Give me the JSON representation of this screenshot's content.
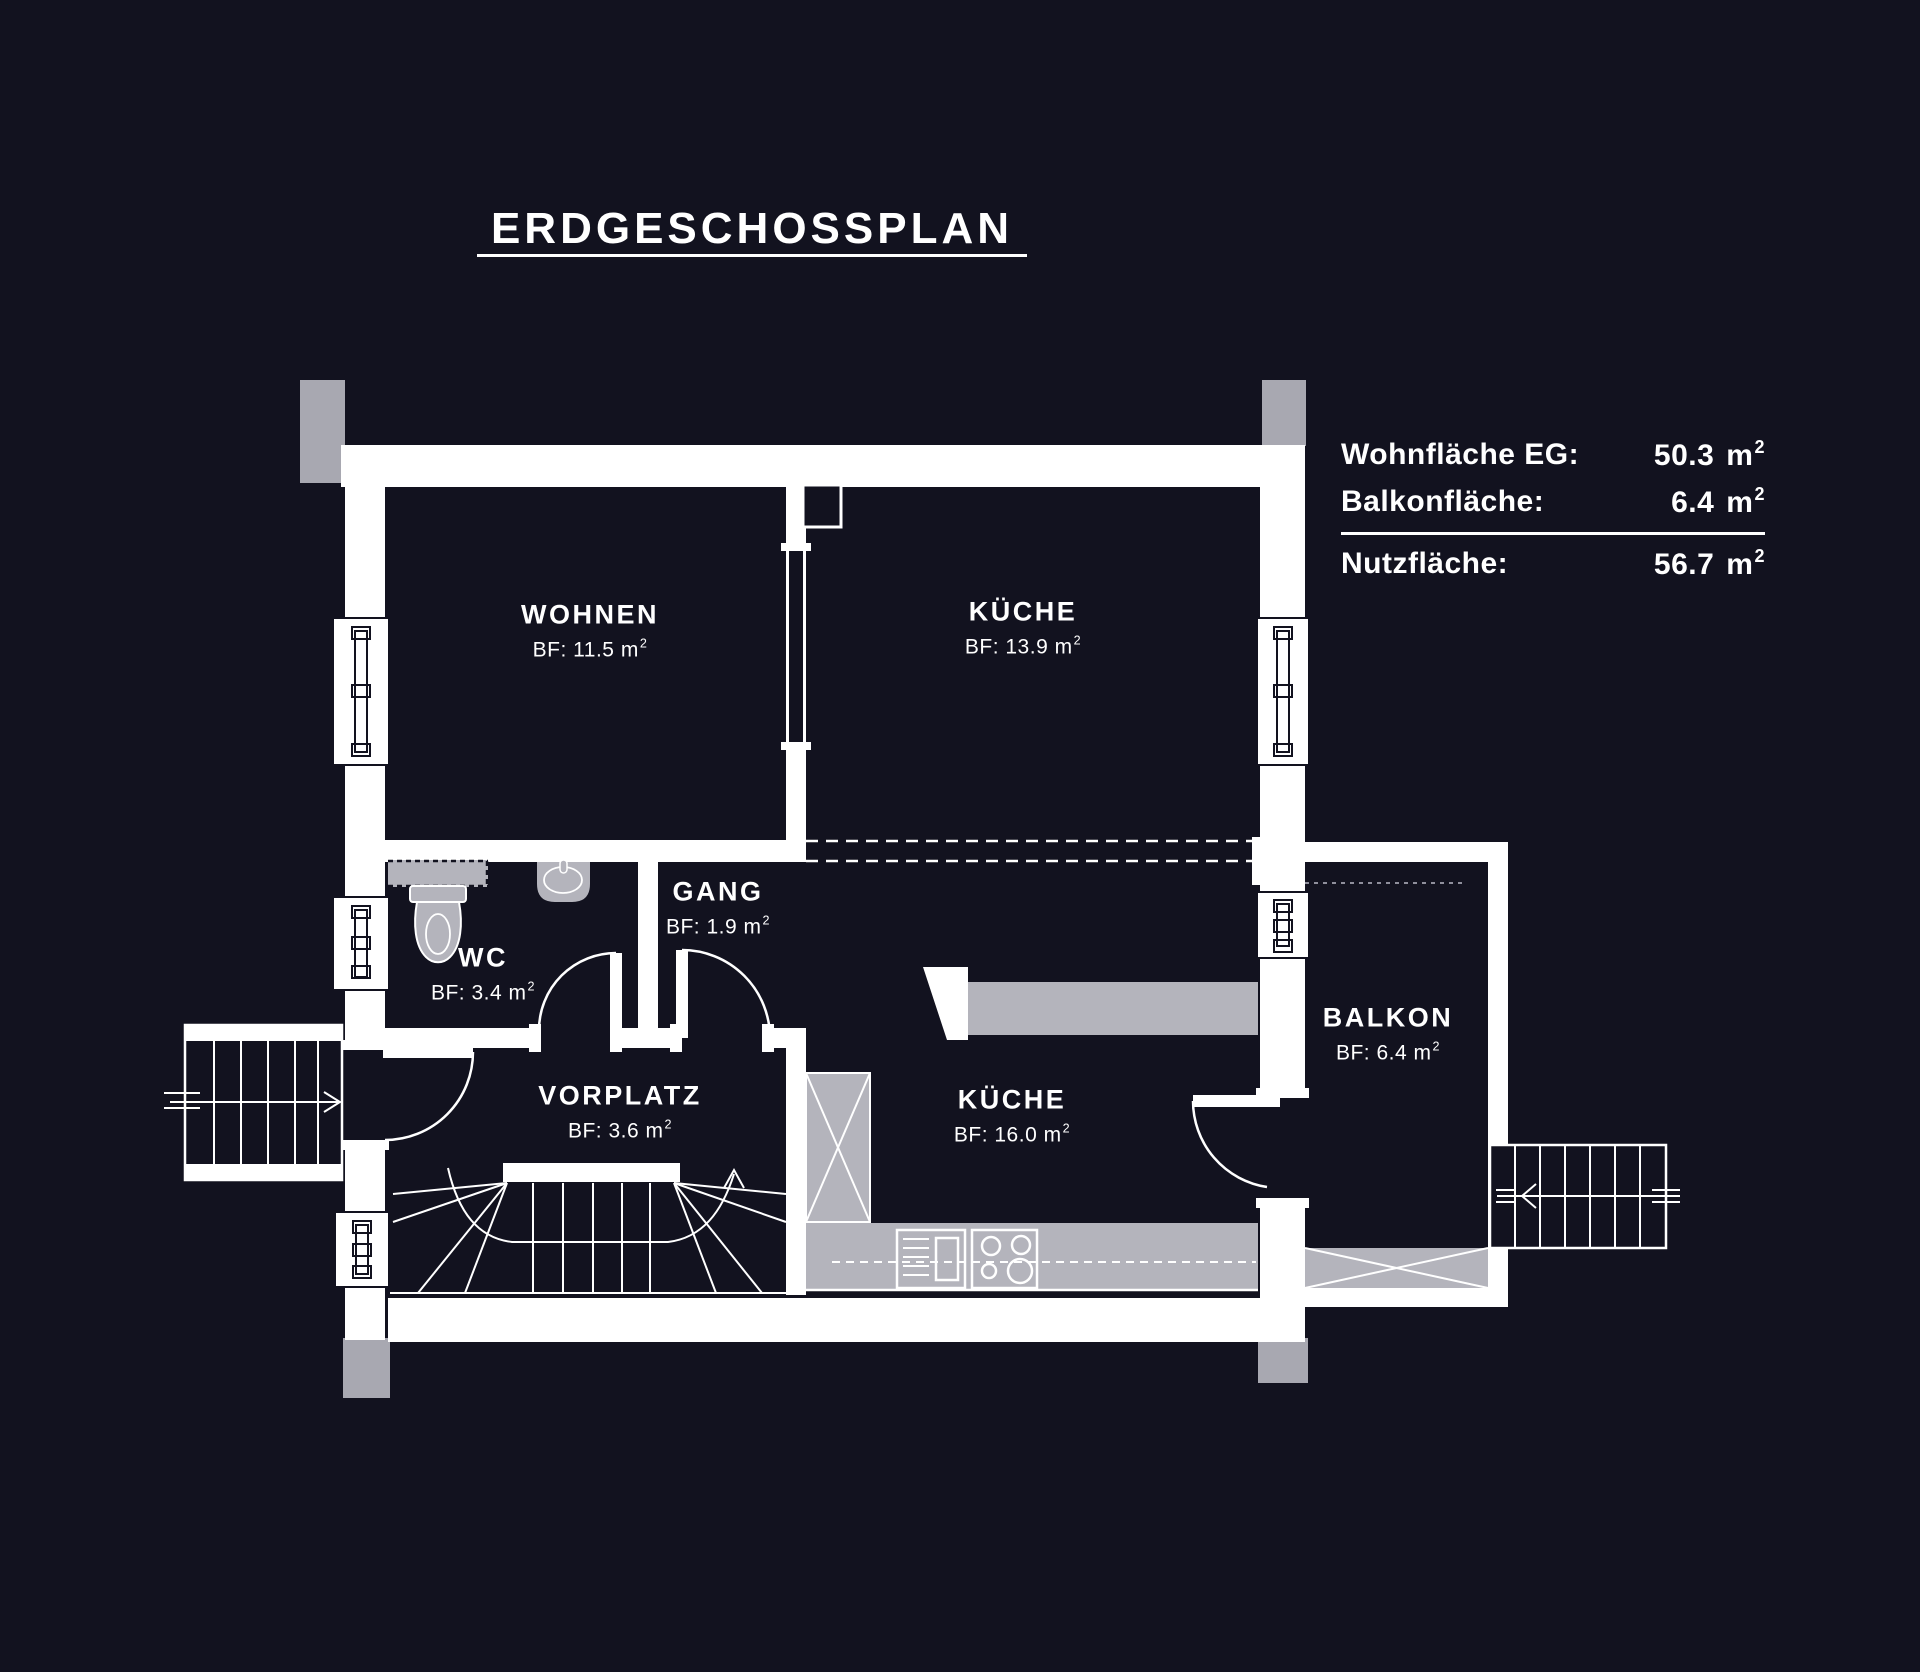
{
  "title": {
    "text": "ERDGESCHOSSPLAN"
  },
  "legend": {
    "rows": [
      {
        "label": "Wohnfläche EG:",
        "value": "50.3",
        "unit": "m",
        "exponent": "2"
      },
      {
        "label": "Balkonfläche:",
        "value": "6.4",
        "unit": "m",
        "exponent": "2"
      },
      {
        "label": "Nutzfläche:",
        "value": "56.7",
        "unit": "m",
        "exponent": "2"
      }
    ]
  },
  "rooms": [
    {
      "id": "wohnen",
      "name": "WOHNEN",
      "area_prefix": "BF: 11.5",
      "unit": "m",
      "exponent": "2"
    },
    {
      "id": "kueche-oben",
      "name": "KÜCHE",
      "area_prefix": "BF: 13.9",
      "unit": "m",
      "exponent": "2"
    },
    {
      "id": "wc",
      "name": "WC",
      "area_prefix": "BF: 3.4",
      "unit": "m",
      "exponent": "2"
    },
    {
      "id": "gang",
      "name": "GANG",
      "area_prefix": "BF: 1.9",
      "unit": "m",
      "exponent": "2"
    },
    {
      "id": "vorplatz",
      "name": "VORPLATZ",
      "area_prefix": "BF: 3.6",
      "unit": "m",
      "exponent": "2"
    },
    {
      "id": "kueche-unten",
      "name": "KÜCHE",
      "area_prefix": "BF: 16.0",
      "unit": "m",
      "exponent": "2"
    },
    {
      "id": "balkon",
      "name": "BALKON",
      "area_prefix": "BF: 6.4",
      "unit": "m",
      "exponent": "2"
    }
  ],
  "colors": {
    "background": "#12121f",
    "wall": "#ffffff",
    "column": "#a8a8b1",
    "fixture": "#b4b4bc",
    "text": "#ffffff",
    "dotted_line": "#8f8f9c"
  }
}
